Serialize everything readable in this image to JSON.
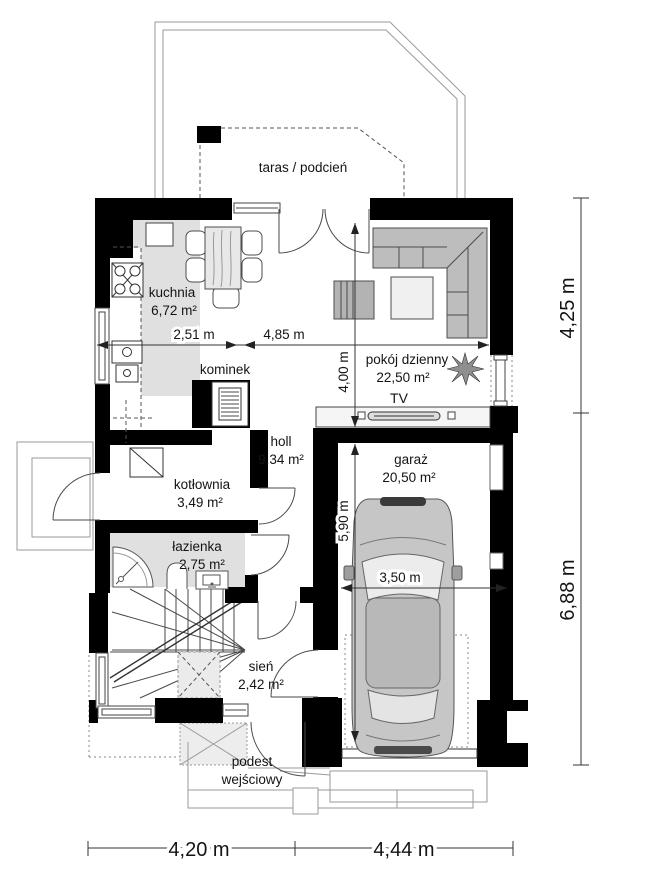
{
  "rooms": {
    "taras": {
      "name": "taras / podcień"
    },
    "kuchnia": {
      "name": "kuchnia",
      "area": "6,72 m²"
    },
    "pokoj_dzienny": {
      "name": "pokój dzienny",
      "area": "22,50 m²"
    },
    "holl": {
      "name": "holl",
      "area": "9,34 m²"
    },
    "kotlownia": {
      "name": "kotłownia",
      "area": "3,49 m²"
    },
    "lazienka": {
      "name": "łazienka",
      "area": "2,75 m²"
    },
    "garaz": {
      "name": "garaż",
      "area": "20,50 m²"
    },
    "sien": {
      "name": "sień",
      "area": "2,42 m²"
    },
    "podest": {
      "name_line1": "podest",
      "name_line2": "wejściowy"
    }
  },
  "labels": {
    "kominek": "kominek",
    "tv": "TV"
  },
  "dimensions": {
    "kitchen_width": "2,51 m",
    "living_width": "4,85 m",
    "living_depth": "4,00 m",
    "garage_length": "5,90 m",
    "garage_width": "3,50 m",
    "right_top": "4,25 m",
    "right_bottom": "6,88 m",
    "bottom_left": "4,20 m",
    "bottom_right": "4,44 m"
  },
  "colors": {
    "wall": "#000000",
    "floor_shade": "#e0e0e0",
    "furniture_gray": "#bdbdbd",
    "line": "#4a4a4a"
  }
}
